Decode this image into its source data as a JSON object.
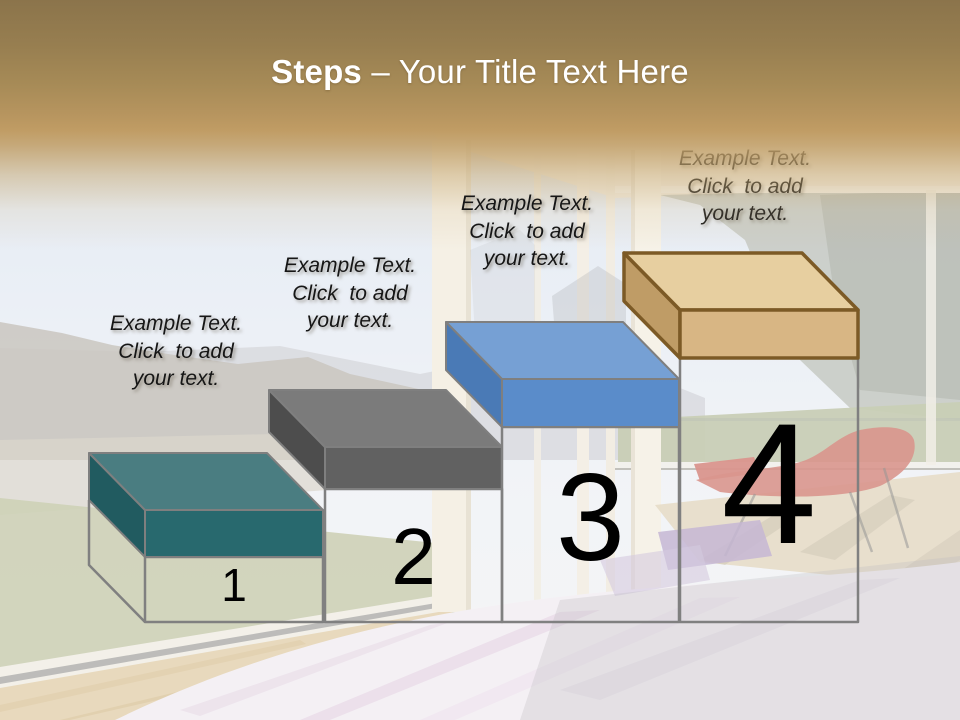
{
  "slide": {
    "title": {
      "bold": "Steps",
      "rest": "– Your Title Text Here"
    }
  },
  "header": {
    "gradient_top_color": "#8b744b",
    "gradient_bottom_color": "#c09c64",
    "title_color": "#ffffff"
  },
  "pedestal": {
    "outline_color": "#808080"
  },
  "steps": [
    {
      "number": "1",
      "label_lines": [
        "Example Text.",
        "Click  to add",
        "your text."
      ],
      "colors": {
        "top": "#4a7d81",
        "front": "#28696e",
        "side": "#215b60",
        "outline": "#7f7f7f"
      }
    },
    {
      "number": "2",
      "label_lines": [
        "Example Text.",
        "Click  to add",
        "your text."
      ],
      "colors": {
        "top": "#7b7b7b",
        "front": "#616161",
        "side": "#4d4d4d",
        "outline": "#7f7f7f"
      }
    },
    {
      "number": "3",
      "label_lines": [
        "Example Text.",
        "Click  to add",
        "your text."
      ],
      "colors": {
        "top": "#76a0d4",
        "front": "#5a8cca",
        "side": "#4a7ab6",
        "outline": "#7f7f7f"
      }
    },
    {
      "number": "4",
      "label_lines": [
        "Example Text.",
        "Click  to add",
        "your text."
      ],
      "colors": {
        "top": "#e7cfa0",
        "front": "#d8b684",
        "side": "#bf9c66",
        "outline": "#7c5a26"
      }
    }
  ]
}
